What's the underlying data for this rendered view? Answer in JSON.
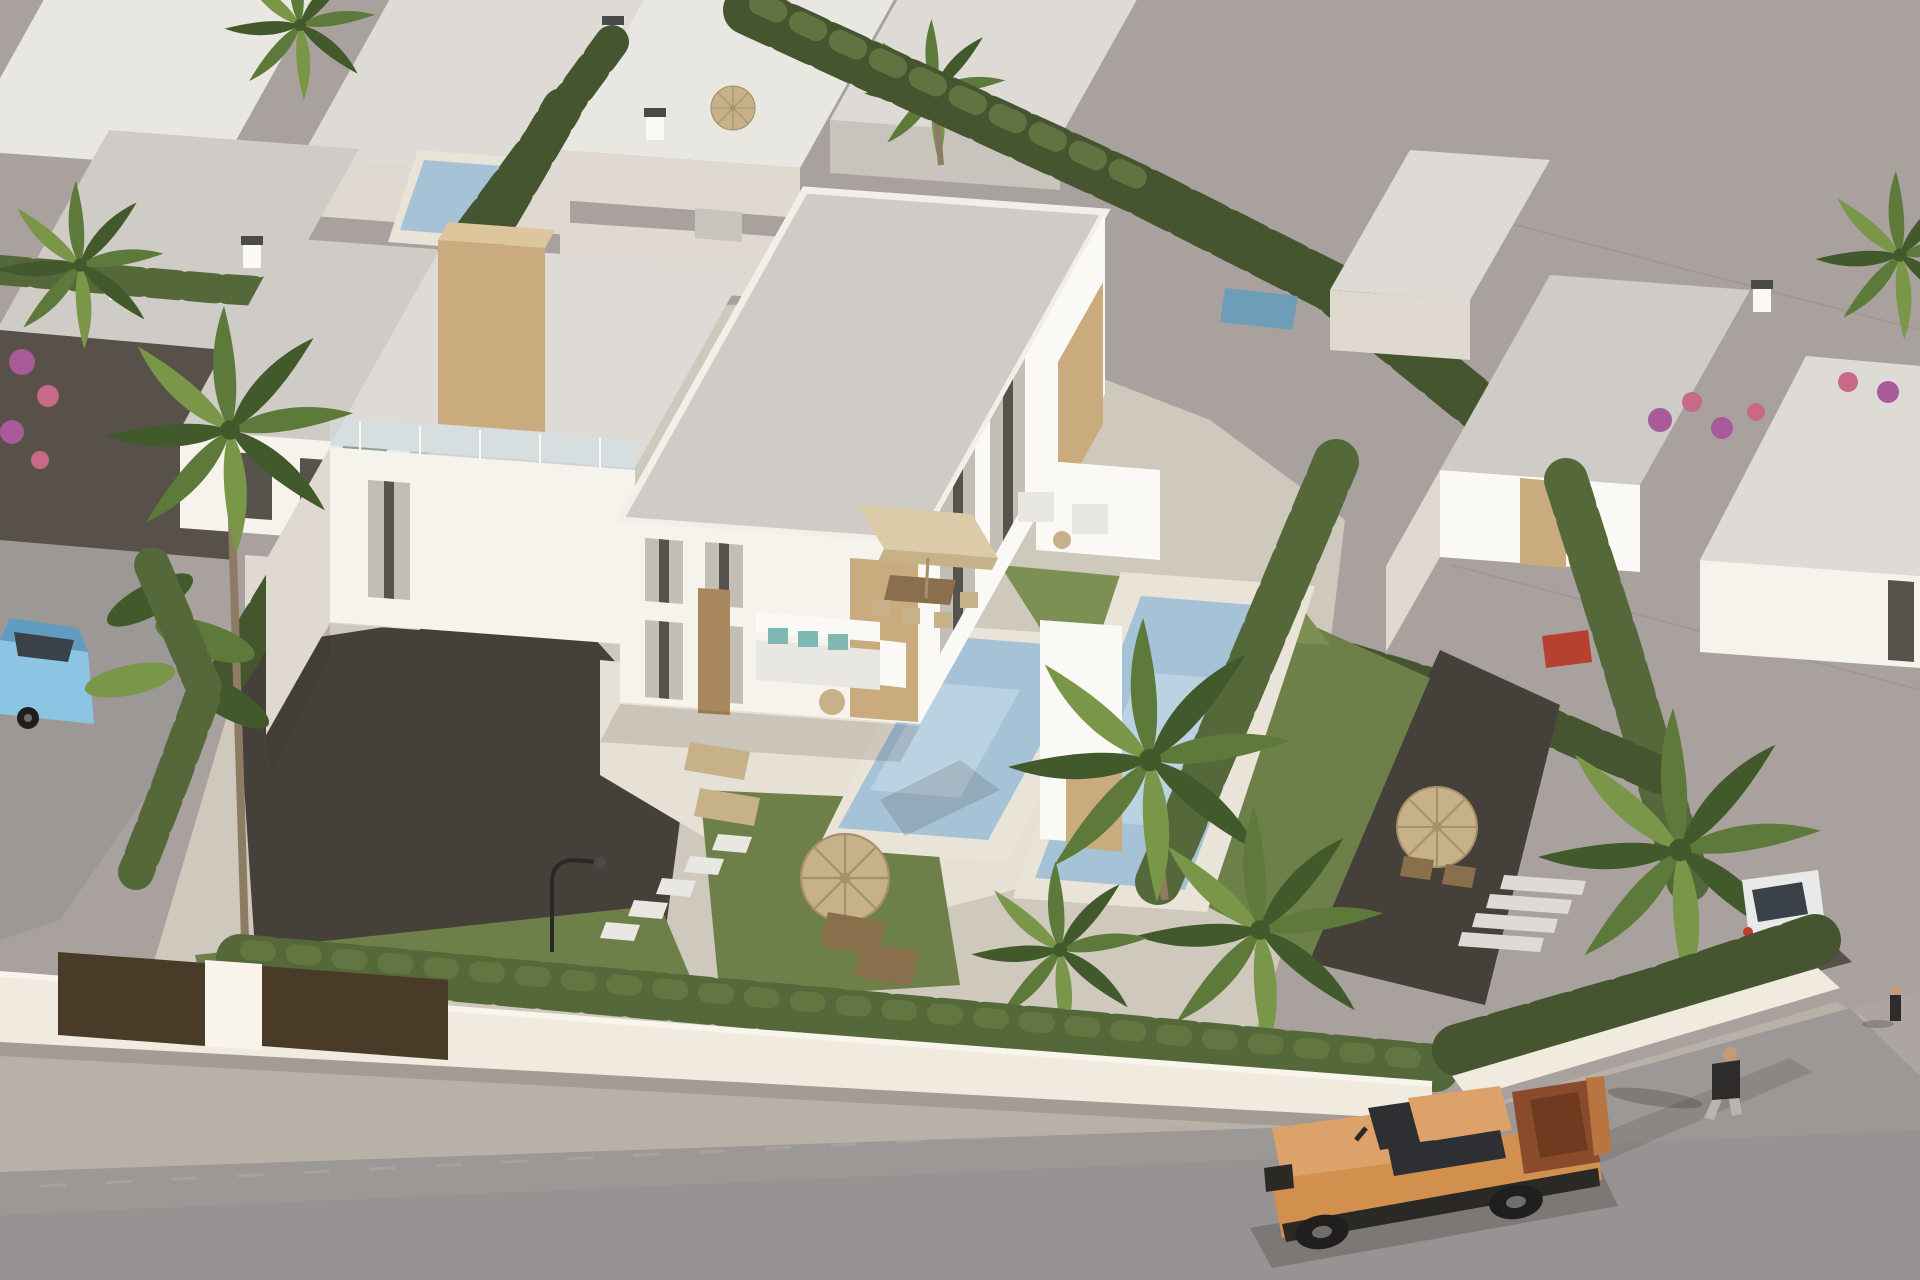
{
  "scene": {
    "type": "3d-architectural-render",
    "view": "aerial",
    "setting": "modern white villa development with private pools beside a street",
    "objects": [
      "white flat-roof villas",
      "stone accent walls",
      "two private swimming pools",
      "thatched parasols",
      "beige dining parasol",
      "orange parasol",
      "outdoor sofa with teal cushions",
      "sun loungers",
      "dining table and chairs",
      "palm trees",
      "banana plants",
      "boxwood hedges",
      "lawns",
      "dark gravel yards",
      "white perimeter wall with dark gates",
      "street lamp",
      "stepping stones",
      "garden stairs",
      "orange pickup truck",
      "light blue car",
      "white car",
      "pedestrian",
      "distant pedestrian",
      "bougainvillea"
    ]
  },
  "palette": {
    "pavement": "#a9a19e",
    "pavement_light": "#b2aaa6",
    "seam": "#988f8b",
    "road": "#9c9896",
    "road_dark": "#949090",
    "dash": "#b5ada5",
    "sidewalk": "#b9b0a8",
    "plot_base": "#cfc8bc",
    "deck": "#e7e1d5",
    "wall": "#f0eadf",
    "wall_top": "#f9f5ec",
    "wall_sun": "#f6f3ed",
    "wall_bright": "#fbf9f5",
    "wall_shade": "#dfd9d0",
    "wall_dark": "#c8c3bc",
    "roof": "#cfccc7",
    "roof_bright": "#dedbd6",
    "roof_pale": "#e9e7e2",
    "parapet": "#f2efe9",
    "stone": "#c9ab7e",
    "stone_light": "#ddc69c",
    "stone_dark": "#a8885c",
    "window": "#56534c",
    "glass": "#6d7277",
    "curtain": "#c2bdb5",
    "hedge_dark": "#44552f",
    "hedge": "#55683a",
    "hedge_light": "#6d8047",
    "grass": "#6e8049",
    "grass_light": "#7d9053",
    "gravel": "#45403a",
    "gravel_light": "#57514a",
    "pool_water": "#a5c2d6",
    "pool_water_light": "#c3d8e5",
    "pool_deck": "#eae4d8",
    "thatch": "#c7b188",
    "thatch_line": "#a8906a",
    "parasol_beige": "#dbcba9",
    "parasol_orange": "#d0714c",
    "wood": "#8a6f4d",
    "lounger_dark": "#6e675e",
    "gate_brown": "#4a3a28",
    "chimney_cap": "#4a4a48",
    "truck_body": "#d2904f",
    "truck_body_light": "#dda269",
    "truck_body_dark": "#b87540",
    "truck_bed": "#8a4a2c",
    "truck_bed_dark": "#6f3a20",
    "truck_glass": "#2e2f33",
    "truck_trim": "#2b2926",
    "tire": "#201f1d",
    "hub": "#6f6e6c",
    "car_blue": "#8cc4e4",
    "car_blue_dark": "#5f9cc0",
    "car_white": "#e9e9ea",
    "car_window": "#3a4148",
    "tail_light": "#c43b2e",
    "red_vehicle": "#b8402e",
    "trunk": "#8d7b63",
    "palm_dark": "#42592c",
    "palm_mid": "#5d7a3a",
    "palm_light": "#7a9648",
    "person_top": "#2e2c2a",
    "person_pants": "#b9b4ae",
    "skin": "#c79b72",
    "flower_purple": "#a85a9a",
    "flower_pink": "#c76a8a",
    "shadow": "rgba(55,50,45,0.28)",
    "shadow_soft": "rgba(55,50,45,0.16)"
  }
}
